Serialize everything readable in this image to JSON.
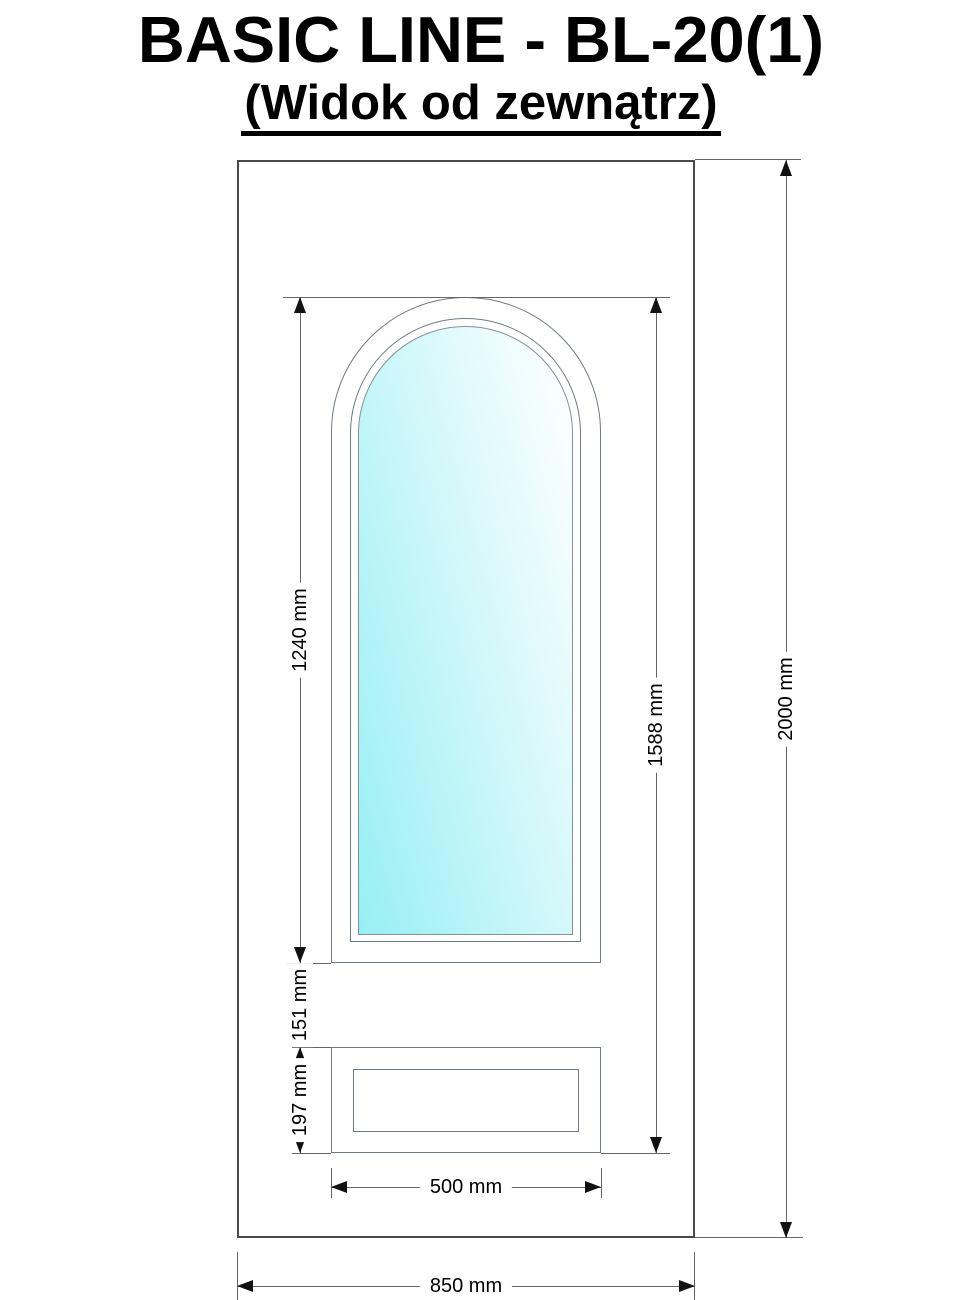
{
  "header": {
    "title": "BASIC LINE - BL-20(1)",
    "subtitle": "(Widok od zewnątrz)"
  },
  "drawing": {
    "labels": {
      "window_height": "1240 mm",
      "window_panel_span_height": "1588 mm",
      "door_height": "2000 mm",
      "mid_gap_height": "151 mm",
      "panel_height": "197 mm",
      "inner_width": "500 mm",
      "door_width": "850 mm"
    },
    "colors": {
      "glass_gradient_start": "#96eff5",
      "glass_gradient_end": "#ffffff",
      "door_outline": "#4a4a4a",
      "frame_line": "#6e7a84",
      "dimension_line": "#666666",
      "arrow": "#111111",
      "text": "#000000"
    }
  }
}
